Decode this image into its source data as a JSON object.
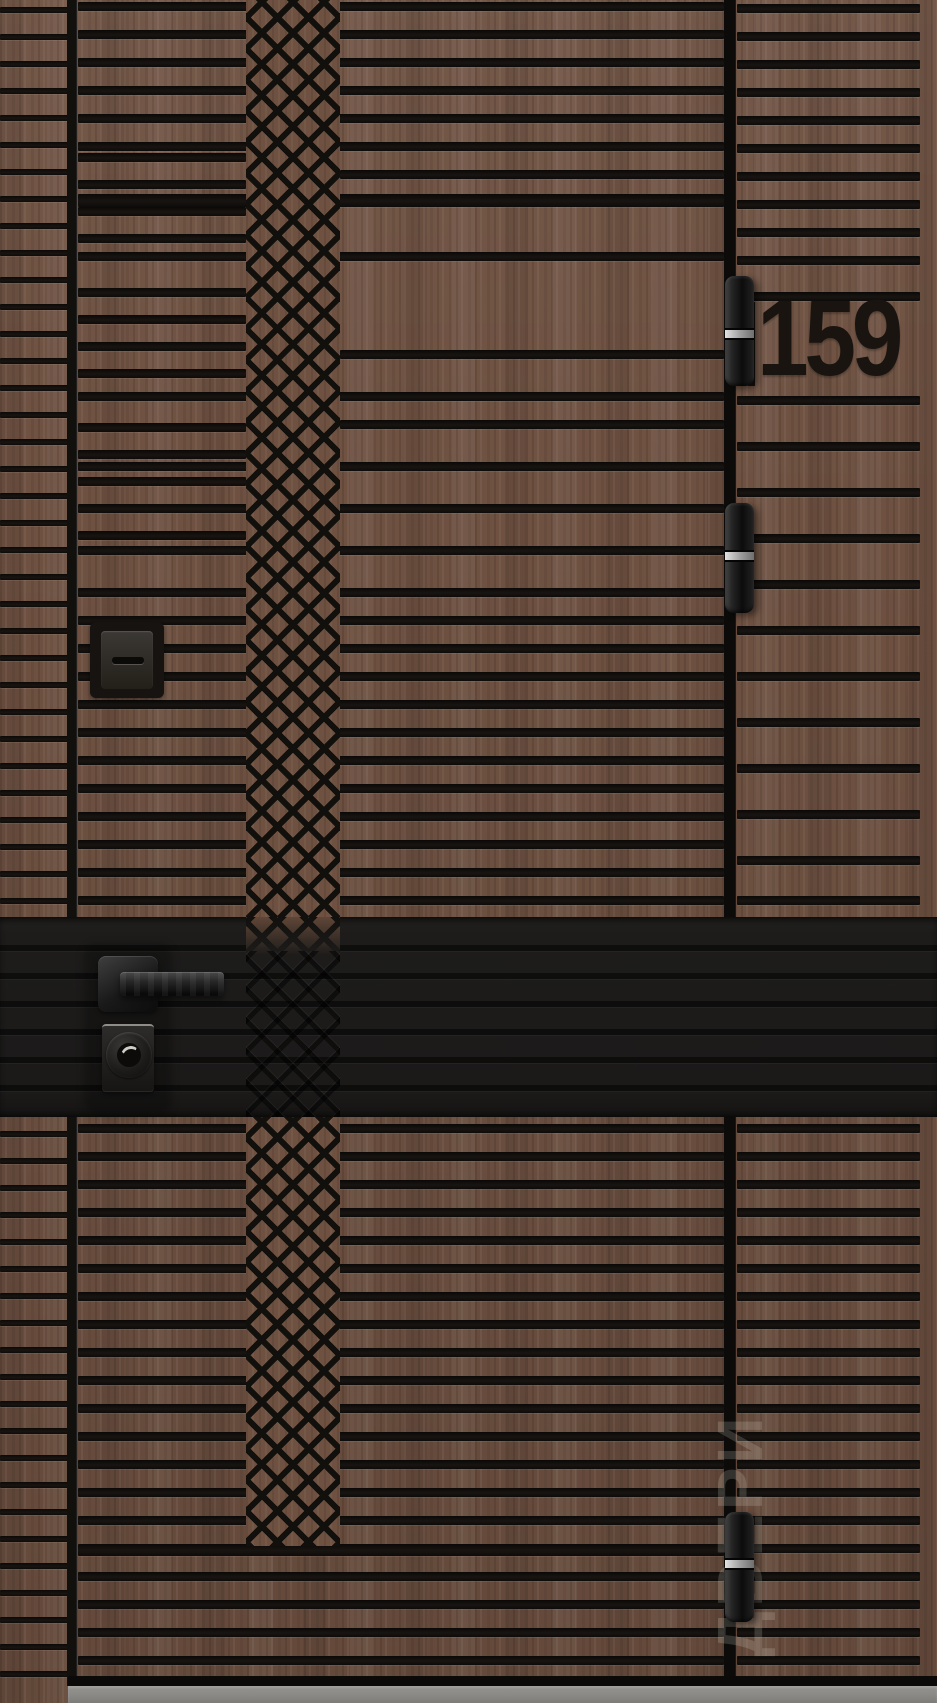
{
  "scene": {
    "description": "Entrance door render: brown wood with black horizontal slat grooves, diamond lattice column, black accent band with handle and locks, house number plate, three hinges, grey threshold",
    "house_number": "159",
    "watermark_text": "ДВЕРИ"
  },
  "colors": {
    "wood_base": "#6e5141",
    "groove_black": "#14110e",
    "accent_band": "#1d1c1b",
    "hardware_black": "#1a1a1a",
    "hinge_metal_band": "#c9c9c9",
    "threshold_grey": "#8a8985",
    "number_color": "#19140f"
  },
  "door": {
    "frame_strip_grooves_y": [
      7,
      34,
      61,
      88,
      115,
      142,
      169,
      196,
      223,
      250,
      277,
      304,
      331,
      358,
      385,
      412,
      439,
      466,
      493,
      520,
      547,
      574,
      601,
      628,
      655,
      682,
      709,
      736,
      763,
      790,
      817,
      844,
      871,
      898,
      1131,
      1158,
      1185,
      1212,
      1239,
      1266,
      1293,
      1320,
      1347,
      1374,
      1401,
      1428,
      1455,
      1482,
      1509,
      1536,
      1563,
      1590,
      1617,
      1644,
      1671
    ],
    "main_panel_grooves": [
      [
        2,
        "F",
        9
      ],
      [
        30,
        "F",
        9
      ],
      [
        58,
        "F",
        9
      ],
      [
        86,
        "F",
        9
      ],
      [
        114,
        "F",
        9
      ],
      [
        142,
        "F",
        9
      ],
      [
        170,
        "R",
        9
      ],
      [
        194,
        "F",
        13
      ],
      [
        153,
        "L",
        9
      ],
      [
        180,
        "L",
        9
      ],
      [
        207,
        "L",
        9
      ],
      [
        234,
        "L",
        9
      ],
      [
        252,
        "F",
        9
      ],
      [
        288,
        "L",
        9
      ],
      [
        315,
        "L",
        9
      ],
      [
        342,
        "L",
        9
      ],
      [
        369,
        "L",
        9
      ],
      [
        350,
        "R",
        9
      ],
      [
        392,
        "F",
        9
      ],
      [
        423,
        "L",
        9
      ],
      [
        450,
        "L",
        9
      ],
      [
        477,
        "L",
        9
      ],
      [
        531,
        "L",
        9
      ],
      [
        420,
        "R",
        9
      ],
      [
        462,
        "F",
        9
      ],
      [
        504,
        "F",
        9
      ],
      [
        546,
        "F",
        9
      ],
      [
        588,
        "F",
        9
      ],
      [
        616,
        "F",
        9
      ],
      [
        644,
        "F",
        9
      ],
      [
        672,
        "F",
        9
      ],
      [
        700,
        "F",
        9
      ],
      [
        728,
        "F",
        9
      ],
      [
        756,
        "F",
        9
      ],
      [
        784,
        "F",
        9
      ],
      [
        812,
        "F",
        9
      ],
      [
        840,
        "F",
        9
      ],
      [
        868,
        "F",
        9
      ],
      [
        896,
        "F",
        9
      ],
      [
        1124,
        "F",
        9
      ],
      [
        1152,
        "F",
        9
      ],
      [
        1180,
        "F",
        9
      ],
      [
        1208,
        "F",
        9
      ],
      [
        1236,
        "F",
        9
      ],
      [
        1264,
        "F",
        9
      ],
      [
        1292,
        "F",
        9
      ],
      [
        1320,
        "F",
        9
      ],
      [
        1348,
        "F",
        9
      ],
      [
        1376,
        "F",
        9
      ],
      [
        1404,
        "F",
        9
      ],
      [
        1432,
        "F",
        9
      ],
      [
        1460,
        "F",
        9
      ],
      [
        1488,
        "F",
        9
      ],
      [
        1516,
        "F",
        9
      ],
      [
        1544,
        "F",
        12
      ],
      [
        1572,
        "F",
        9
      ],
      [
        1600,
        "F",
        9
      ],
      [
        1628,
        "F",
        9
      ],
      [
        1656,
        "F",
        9
      ]
    ],
    "side_panel_grooves_y": [
      4,
      32,
      60,
      88,
      116,
      144,
      172,
      200,
      228,
      256,
      292,
      396,
      442,
      488,
      534,
      580,
      626,
      672,
      718,
      764,
      810,
      856,
      896,
      1124,
      1152,
      1180,
      1208,
      1236,
      1264,
      1292,
      1320,
      1348,
      1376,
      1404,
      1432,
      1460,
      1488,
      1516,
      1544,
      1572,
      1600,
      1628,
      1656
    ],
    "accent_band_ridges_y": [
      28,
      56,
      84,
      112,
      140,
      168
    ],
    "hinges": [
      {
        "top": 276,
        "band_top": 54
      },
      {
        "top": 503,
        "band_top": 49
      },
      {
        "top": 1512,
        "band_top": 48
      }
    ]
  }
}
